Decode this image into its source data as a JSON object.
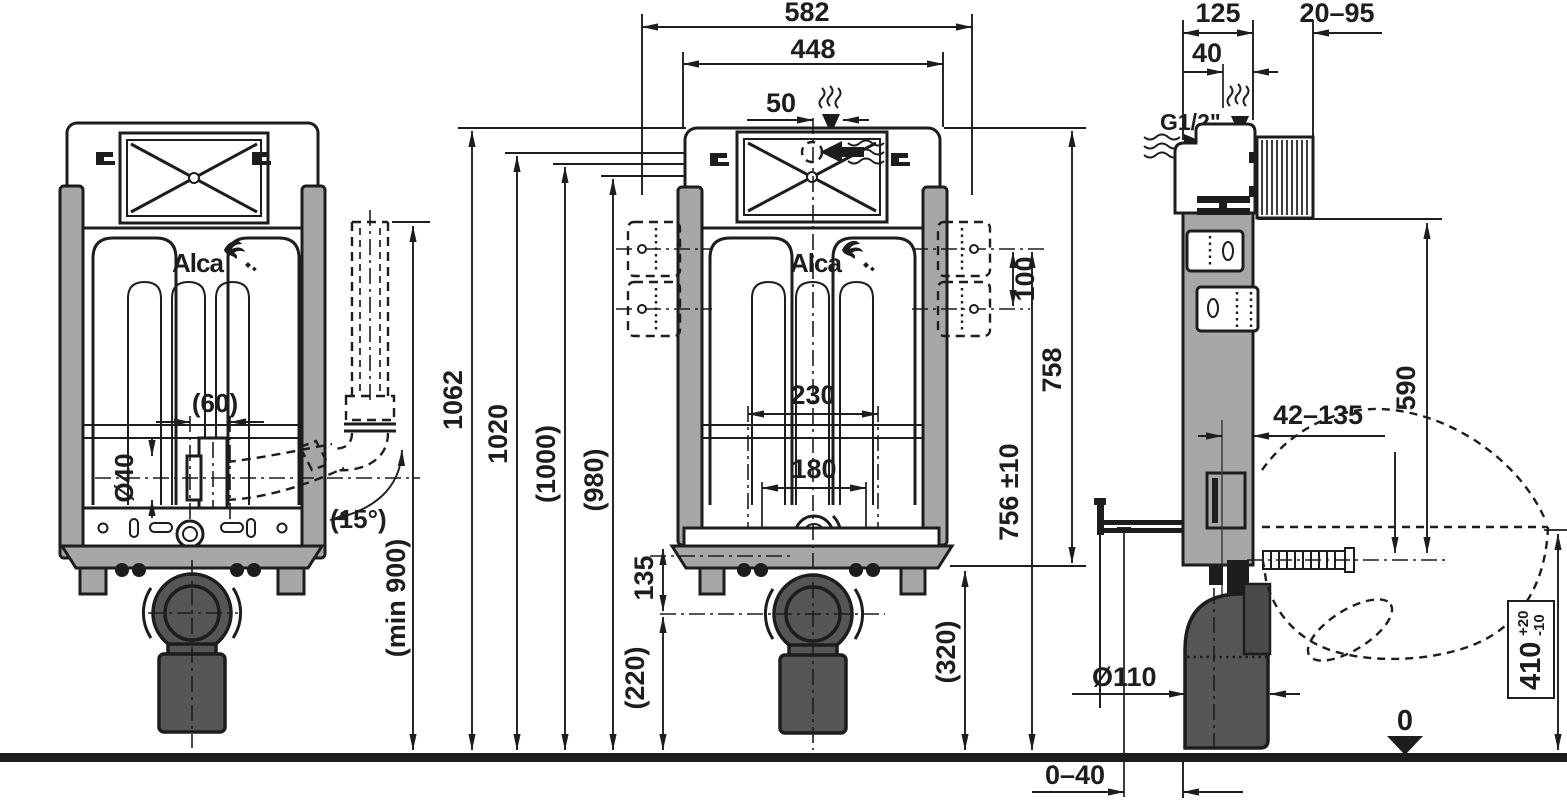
{
  "drawing": {
    "logo_text": "Alca",
    "left_view": {
      "dims": {
        "spigot_offset": "(60)",
        "pipe_diameter": "Ø40",
        "elbow_angle": "(15°)",
        "min_height": "(min 900)"
      }
    },
    "front_view": {
      "dims": {
        "total_width": "582",
        "frame_width": "448",
        "inlet_offset": "50",
        "total_height": "1062",
        "height_1020": "1020",
        "height_1000": "(1000)",
        "height_980": "(980)",
        "bracket_spacing": "100",
        "frame_height": "758",
        "plate_height": "756 ±10",
        "bolt_span_outer": "230",
        "bolt_span_inner": "180",
        "drain_drop": "135",
        "drain_height": "(220)",
        "base_height": "(320)"
      }
    },
    "side_view": {
      "dims": {
        "frame_depth": "125",
        "wall_thickness": "20–95",
        "inlet_setback": "40",
        "thread_size": "G1/2\"",
        "upper_height": "590",
        "adjust_range": "42–135",
        "drain_diameter": "Ø110",
        "bowl_height": "410",
        "bowl_tol_plus": "+20",
        "bowl_tol_minus": "-10",
        "floor_level": "0",
        "floor_gap": "0–40"
      }
    }
  }
}
